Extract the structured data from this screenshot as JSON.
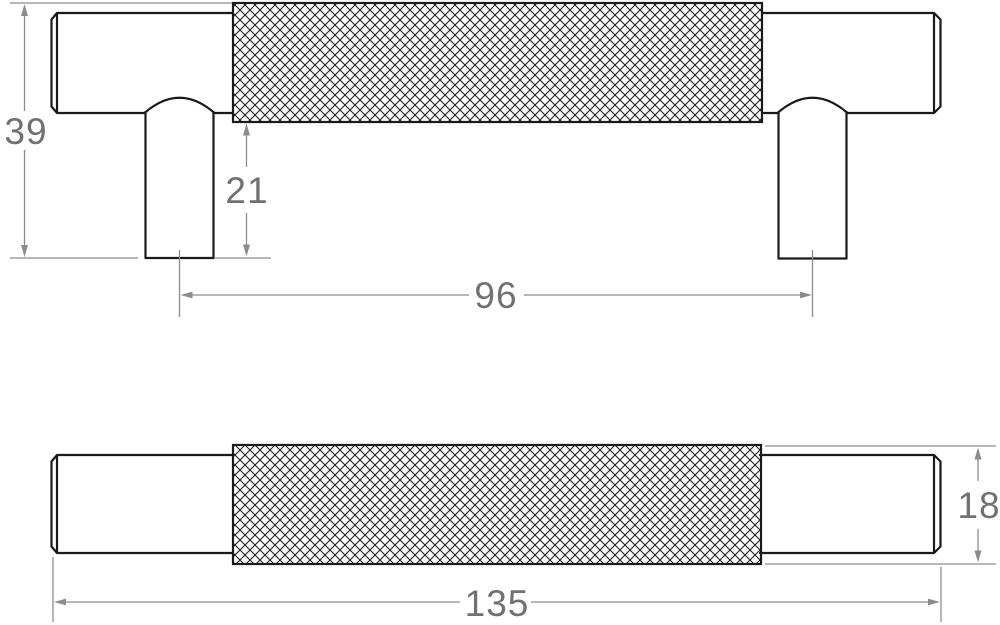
{
  "drawing": {
    "dimensions": {
      "front_view": {
        "overall_height": "39",
        "post_projection": "21",
        "fixing_centres": "96"
      },
      "plan_view": {
        "overall_length": "135",
        "bar_diameter": "18"
      }
    },
    "colors": {
      "background": "#ffffff",
      "part_outline": "#1a1a1a",
      "knurl_hatch": "#1f1f1f",
      "dimension_lines": "#8c8c8c",
      "dimension_text": "#717171"
    }
  }
}
